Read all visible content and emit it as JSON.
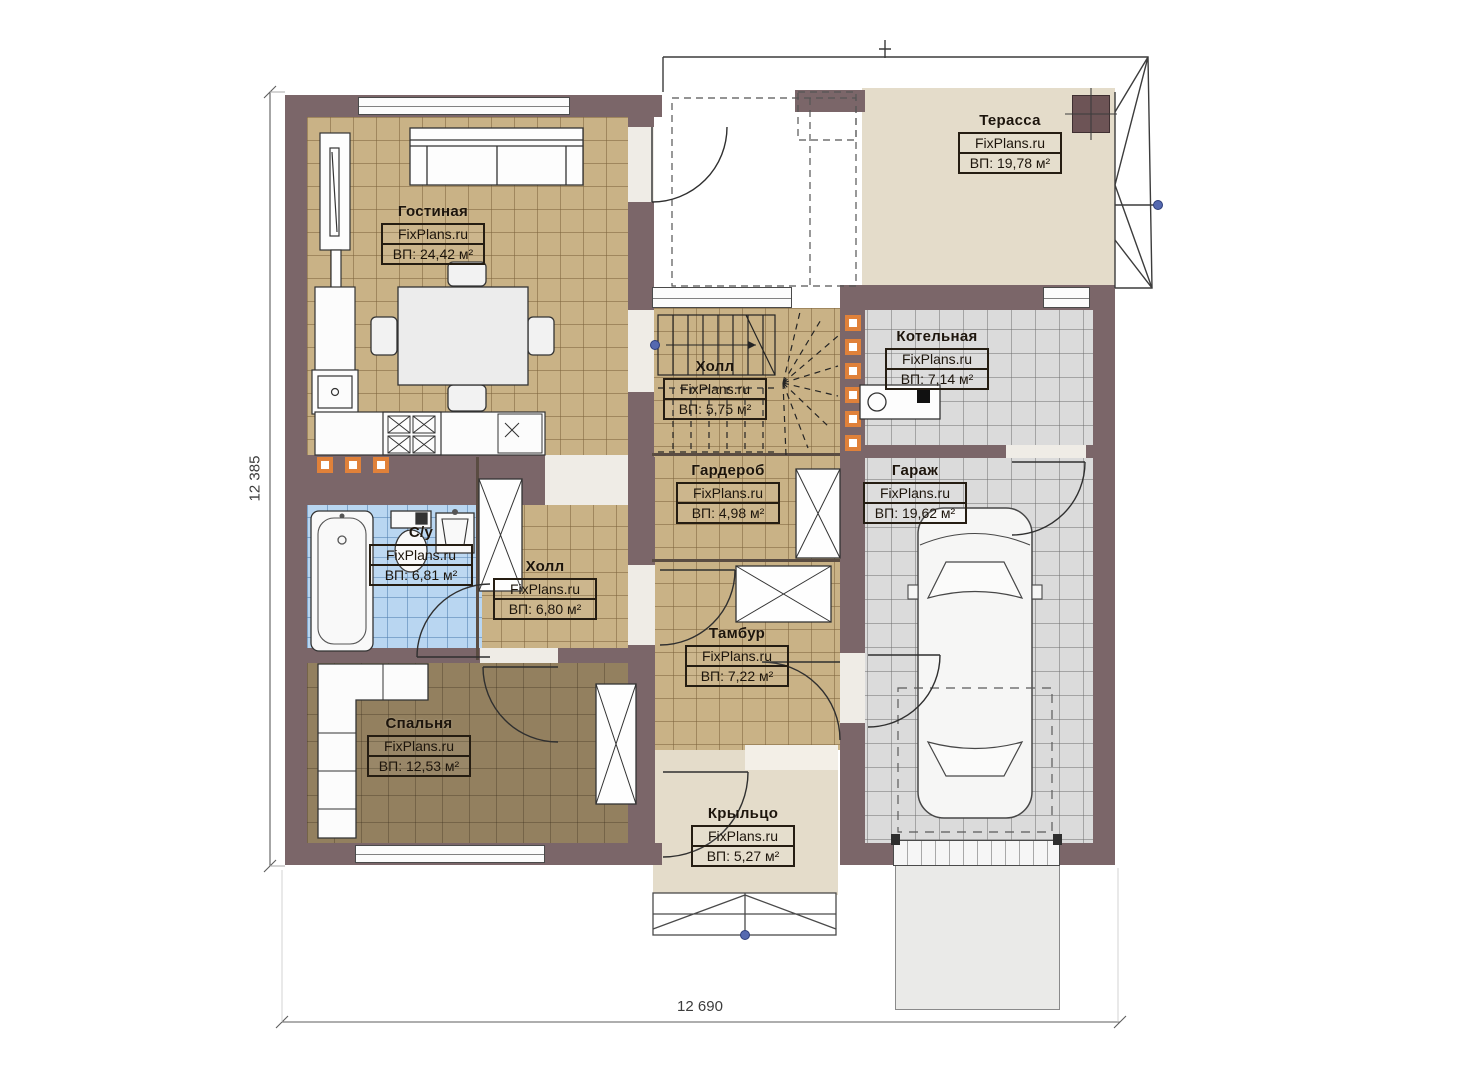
{
  "plan": {
    "watermark": "FixPlans.ru",
    "dimensions": {
      "height_label": "12 385",
      "width_label": "12 690"
    },
    "rooms": [
      {
        "name": "Гостиная",
        "site": "FixPlans.ru",
        "area": "ВП: 24,42 м²"
      },
      {
        "name": "Терасса",
        "site": "FixPlans.ru",
        "area": "ВП: 19,78 м²"
      },
      {
        "name": "Котельная",
        "site": "FixPlans.ru",
        "area": "ВП: 7,14 м²"
      },
      {
        "name": "Холл",
        "site": "FixPlans.ru",
        "area": "ВП: 5,75 м²"
      },
      {
        "name": "Гардероб",
        "site": "FixPlans.ru",
        "area": "ВП: 4,98 м²"
      },
      {
        "name": "Гараж",
        "site": "FixPlans.ru",
        "area": "ВП: 19,62 м²"
      },
      {
        "name": "С/у",
        "site": "FixPlans.ru",
        "area": "ВП: 6,81 м²"
      },
      {
        "name": "Холл",
        "site": "FixPlans.ru",
        "area": "ВП: 6,80 м²"
      },
      {
        "name": "Тамбур",
        "site": "FixPlans.ru",
        "area": "ВП: 7,22 м²"
      },
      {
        "name": "Спальня",
        "site": "FixPlans.ru",
        "area": "ВП: 12,53 м²"
      },
      {
        "name": "Крыльцо",
        "site": "FixPlans.ru",
        "area": "ВП: 5,27 м²"
      }
    ],
    "colors": {
      "wall": "#7b6669",
      "floor-tan": "#c9b286",
      "floor-gray": "#dbdbdb",
      "floor-blue": "#b9d6f1",
      "floor-brown": "#93805f",
      "floor-beige": "#e4dcca",
      "accent-orange": "#e0813a",
      "node-blue": "#5569b0"
    }
  }
}
